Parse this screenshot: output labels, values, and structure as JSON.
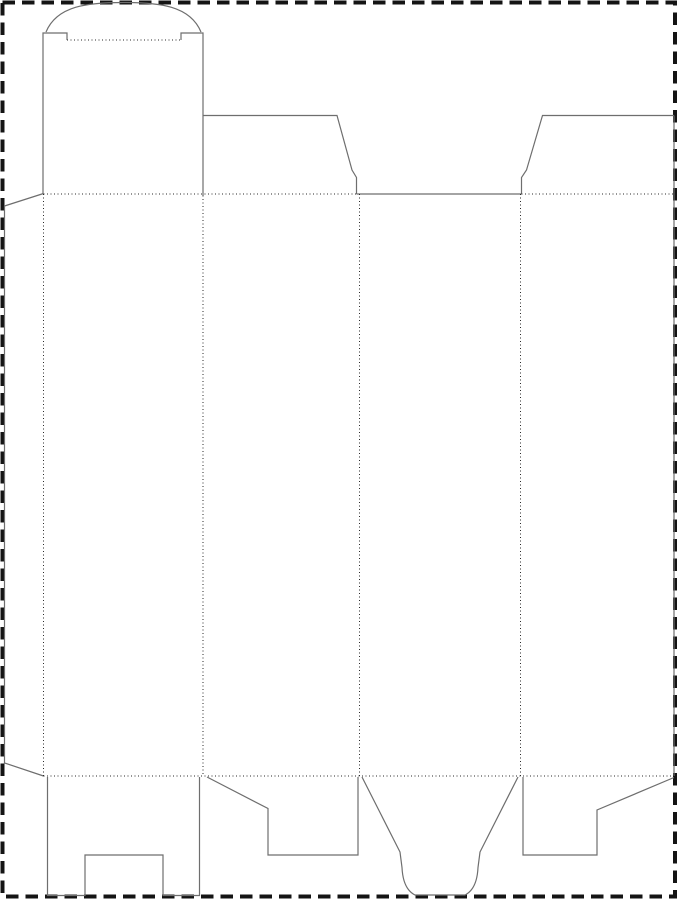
{
  "canvas": {
    "width": 677,
    "height": 900,
    "background": "#ffffff"
  },
  "styles": {
    "cut_color": "#6e6e6e",
    "cut_width": 1.2,
    "fold_color": "#2a2a2a",
    "fold_width": 1,
    "fold_dash": "1 2.5",
    "border_color": "#141414",
    "border_width": 4,
    "border_dash": "12.5 7"
  },
  "page_border": {
    "x": 2.5,
    "y": 2.5,
    "width": 672.5,
    "height": 894
  },
  "drawing_title": "carton-dieline-tuck-top-snap-lock-bottom",
  "cut_lines": [
    {
      "name": "glue-flap-outline",
      "d": "M43.5,193.5 L4.5,206 L4.5,763 L43.5,776"
    },
    {
      "name": "lid-left-edge-shoulder",
      "d": "M43,194 L43,33 L67,33 L67,40"
    },
    {
      "name": "lid-right-edge-shoulder",
      "d": "M181,40 L181,33 L203,33 L203,195.5"
    },
    {
      "name": "tuck-flap-arc",
      "d": "M46,32 C57,5.5 88,2.5 123.5,2.5 C159,2.5 190,5.5 201,32"
    },
    {
      "name": "panel2-dust-flap",
      "d": "M203,115.5 L337,115.5 L352,170 L356.5,177.5 L356.5,194"
    },
    {
      "name": "panel3-top-cut",
      "d": "M356.5,194 L521.5,194"
    },
    {
      "name": "panel4-dust-flap",
      "d": "M521.5,194 L521.5,177.5 L526.5,170 L542.5,115.5 L674,115.5"
    },
    {
      "name": "right-panel-edge",
      "d": "M674,115.5 L674,776"
    },
    {
      "name": "panel1-bottom-slotted-flap",
      "d": "M47.5,777 L47.5,895.5 L85,895.5 L85,855 L163,855 L163,895.5 L199.5,895.5 L199.5,777"
    },
    {
      "name": "panel2-bottom-lock-flap",
      "d": "M207,777 L268,808.5 L268,855 L358,855 L358,777"
    },
    {
      "name": "panel3-bottom-tongue",
      "d": "M362,777 L400,852 L402,867.5 Q403,889 415,895 L465,895 Q477,889 478,867.5 L480,852 L518,777"
    },
    {
      "name": "panel4-bottom-lock-flap",
      "d": "M523,777 L523,855 L597,855 L597,810 L674,777.5"
    }
  ],
  "fold_lines": [
    {
      "name": "tuck-flap-fold",
      "d": "M67,40 L181,40"
    },
    {
      "name": "top-fold-left",
      "d": "M43.5,194 L356.5,194"
    },
    {
      "name": "top-fold-right",
      "d": "M521.5,194 L674,194"
    },
    {
      "name": "bottom-fold",
      "d": "M43.5,776 L674,776"
    },
    {
      "name": "glue-flap-fold",
      "d": "M43.5,194 L43.5,776"
    },
    {
      "name": "fold-panel1-panel2",
      "d": "M203,195.5 L203,776"
    },
    {
      "name": "fold-panel2-panel3",
      "d": "M359.5,194 L359.5,776"
    },
    {
      "name": "fold-panel3-panel4",
      "d": "M520.5,194 L520.5,776"
    }
  ]
}
